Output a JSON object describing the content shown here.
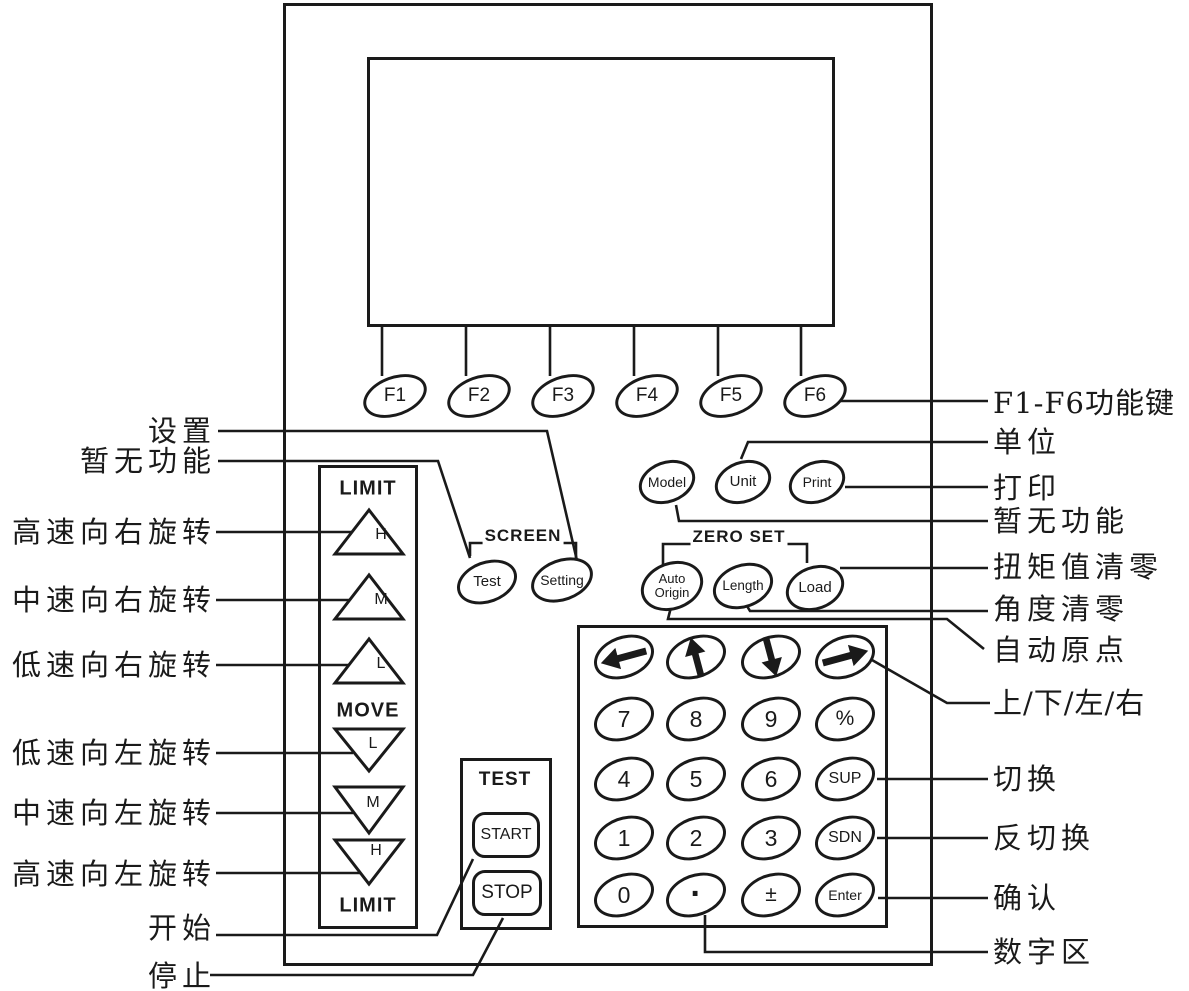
{
  "colors": {
    "ink": "#1a1a1a",
    "background": "#ffffff"
  },
  "keys": {
    "function": [
      "F1",
      "F2",
      "F3",
      "F4",
      "F5",
      "F6"
    ],
    "model": "Model",
    "unit": "Unit",
    "print": "Print",
    "auto_origin_line1": "Auto",
    "auto_origin_line2": "Origin",
    "length": "Length",
    "load": "Load",
    "test": "Test",
    "setting": "Setting",
    "start": "START",
    "stop": "STOP"
  },
  "groups": {
    "screen": "SCREEN",
    "zero_set": "ZERO SET",
    "test": "TEST",
    "limit_top": "LIMIT",
    "move": "MOVE",
    "limit_bottom": "LIMIT"
  },
  "limit_keys": {
    "up": [
      "H",
      "M",
      "L"
    ],
    "down": [
      "L",
      "M",
      "H"
    ]
  },
  "keypad": {
    "arrow_icons": [
      "left-arrow",
      "up-arrow",
      "down-arrow",
      "right-arrow"
    ],
    "rows": [
      [
        "7",
        "8",
        "9",
        "%"
      ],
      [
        "4",
        "5",
        "6",
        "SUP"
      ],
      [
        "1",
        "2",
        "3",
        "SDN"
      ],
      [
        "0",
        "·",
        "±",
        "Enter"
      ]
    ]
  },
  "annotations": {
    "left": [
      "设置",
      "暂无功能",
      "高速向右旋转",
      "中速向右旋转",
      "低速向右旋转",
      "低速向左旋转",
      "中速向左旋转",
      "高速向左旋转",
      "开始",
      "停止"
    ],
    "right": [
      "F1-F6功能键",
      "单位",
      "打印",
      "暂无功能",
      "扭矩值清零",
      "角度清零",
      "自动原点",
      "上/下/左/右",
      "切换",
      "反切换",
      "确认",
      "数字区"
    ]
  }
}
